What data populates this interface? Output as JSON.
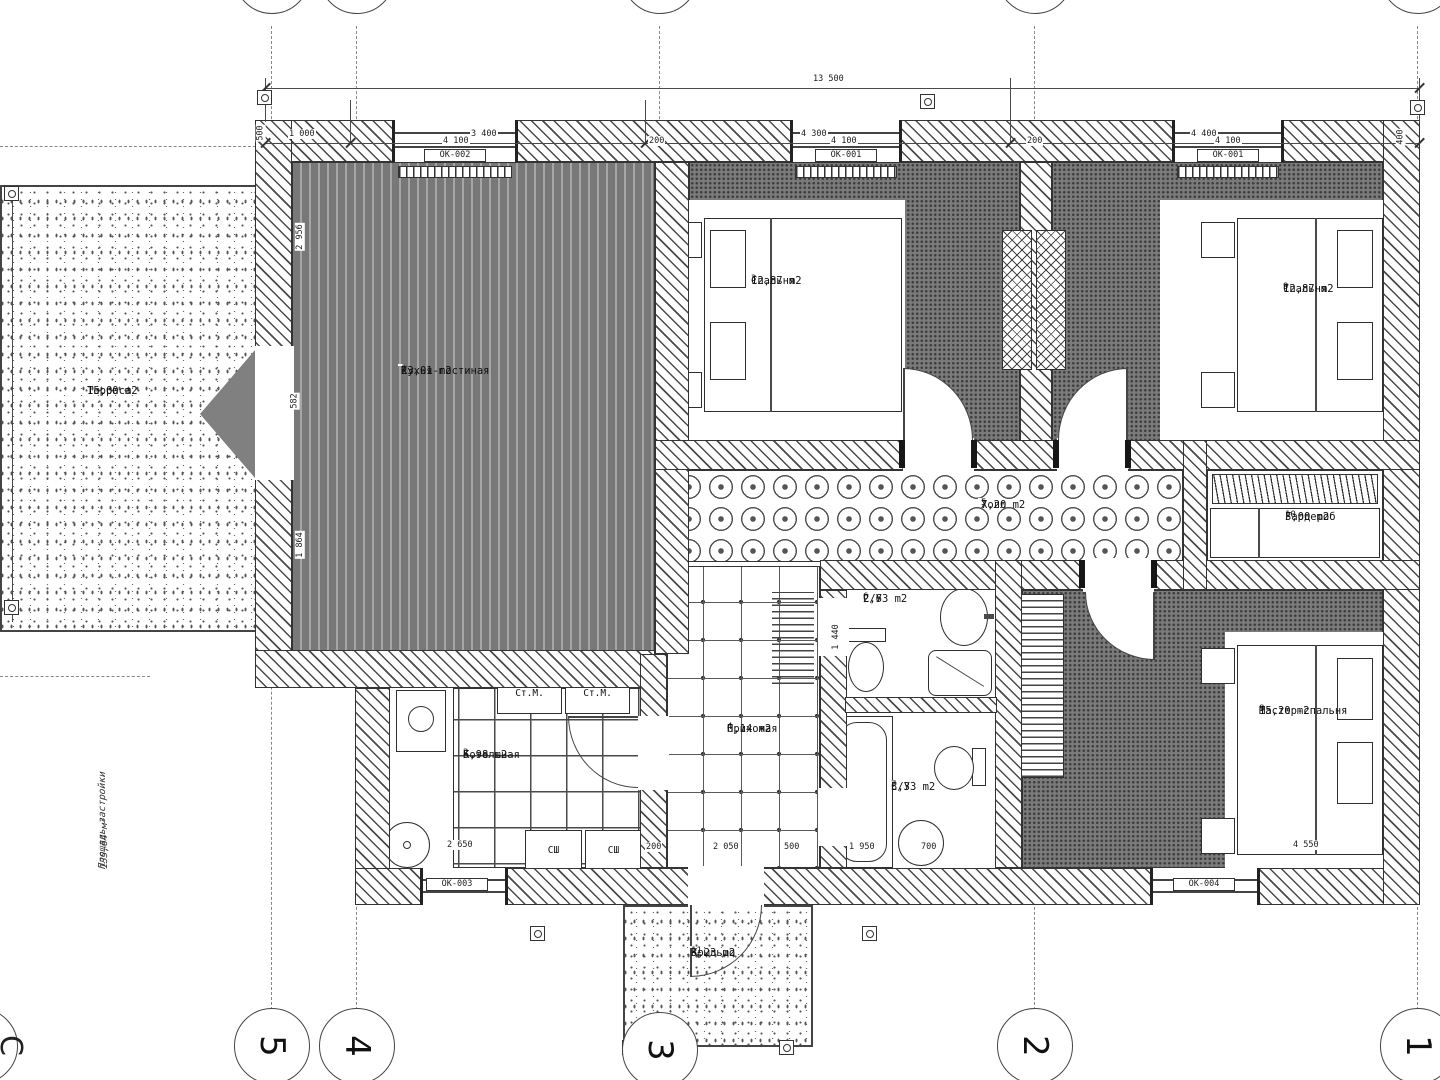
{
  "drawing": {
    "type": "floor-plan",
    "axis_numbers": [
      "5",
      "4",
      "3",
      "2",
      "1"
    ],
    "axis_letter": "С",
    "site_area": {
      "label": "Площадь застройки",
      "value": "135,64 м²"
    }
  },
  "dims": {
    "top_total": "13 500",
    "top_segments": [
      "1 000",
      "3 400",
      "4 300",
      "4 400"
    ],
    "top_wall": [
      "500",
      "4 100",
      "200",
      "4 100",
      "200",
      "4 100",
      "400"
    ],
    "left_wall": [
      "2 956",
      "582",
      "1 864"
    ],
    "bottom_wall": [
      "2 650",
      "200",
      "2 050",
      "500",
      "1 950",
      "700",
      "4 550"
    ],
    "bath": [
      "1 440"
    ]
  },
  "rooms": [
    {
      "name": "Кухня-гостиная",
      "number": "1",
      "area": "23,01 m2"
    },
    {
      "name": "Котельная",
      "number": "2",
      "area": "5,98 m2"
    },
    {
      "name": "Спальня",
      "number": "3",
      "area": "12,87 m2"
    },
    {
      "name": "Прихожая",
      "number": "4",
      "area": "6,14 m2"
    },
    {
      "name": "Холл",
      "number": "5",
      "area": "7,20 m2"
    },
    {
      "name": "С/У",
      "number": "6",
      "area": "2,63 m2"
    },
    {
      "name": "С/У",
      "number": "7",
      "area": "3,33 m2"
    },
    {
      "name": "Мастер-спальня",
      "number": "8",
      "area": "15,20 m2"
    },
    {
      "name": "Спальня",
      "number": "9",
      "area": "12,87 m2"
    },
    {
      "name": "Гардероб",
      "number": "10",
      "area": "3,00 m2"
    },
    {
      "name": "Крыльцо",
      "number": "11",
      "area": "3,23 m2"
    },
    {
      "name": "Терраса",
      "number": "",
      "area": "15,00 m2"
    }
  ],
  "windows": {
    "w1": "ОК-002",
    "w2": "ОК-001",
    "w3": "ОК-001",
    "w4": "ОК-003",
    "w5": "ОК-004"
  },
  "equipment": {
    "washer1": "Ст.М.",
    "washer2": "Ст.М.",
    "dryer1": "СШ",
    "dryer2": "СШ"
  }
}
